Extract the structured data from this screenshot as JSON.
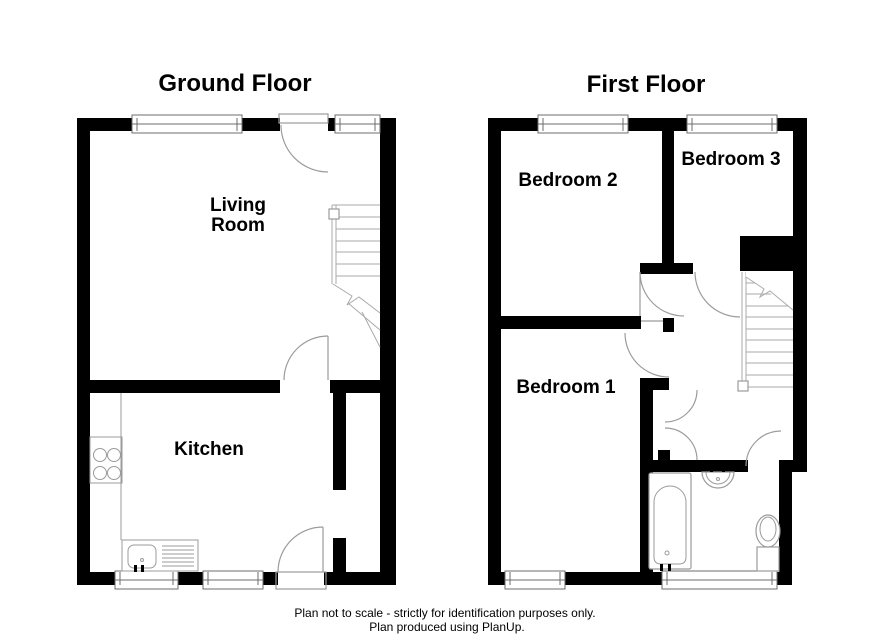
{
  "colors": {
    "background": "#ffffff",
    "wall": "#000000",
    "fixture_line": "#9b9b9b",
    "window_line": "#6e6e6e",
    "text": "#000000"
  },
  "ground_floor": {
    "title": "Ground Floor",
    "rooms": {
      "living_room_line1": "Living",
      "living_room_line2": "Room",
      "kitchen": "Kitchen"
    }
  },
  "first_floor": {
    "title": "First Floor",
    "rooms": {
      "bedroom1": "Bedroom 1",
      "bedroom2": "Bedroom 2",
      "bedroom3": "Bedroom 3"
    }
  },
  "footer": {
    "line1": "Plan not to scale - strictly for identification purposes only.",
    "line2": "Plan produced using PlanUp."
  }
}
